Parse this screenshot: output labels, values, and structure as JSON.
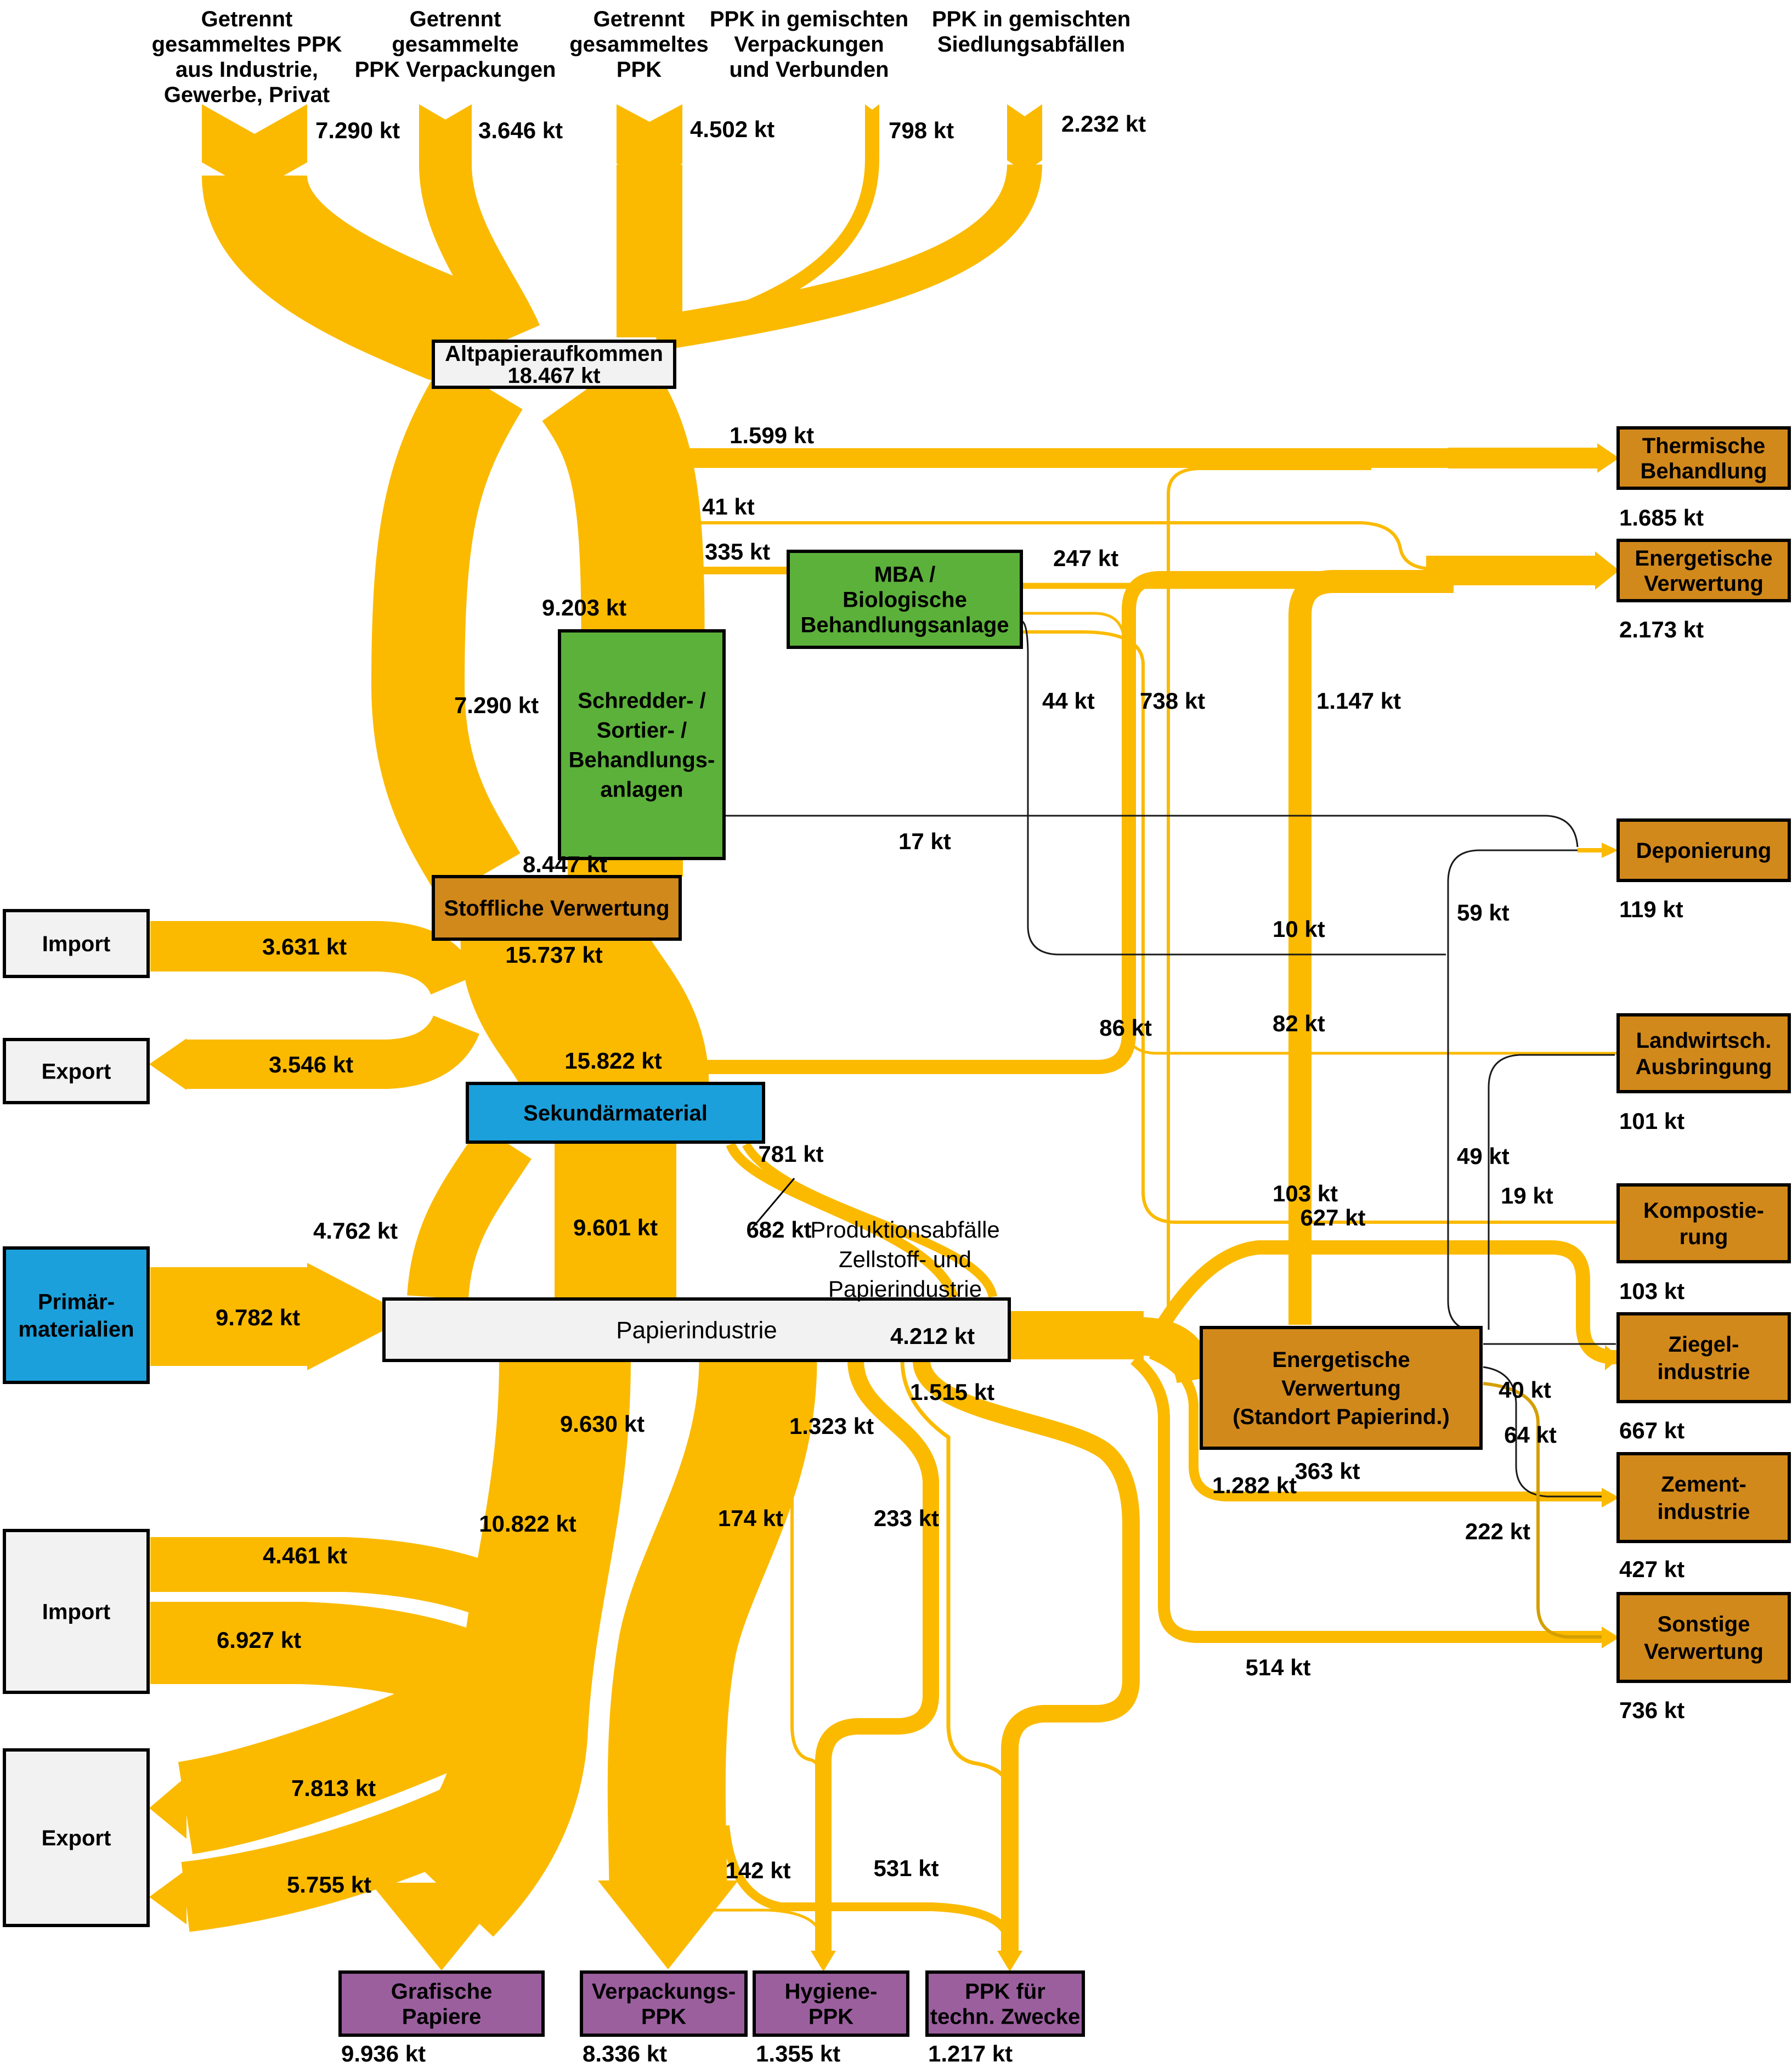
{
  "title": "PPK Stoffstrom Sankey",
  "colors": {
    "flow_yellow": "#FBBA00",
    "hairline_black": "#1a1a1a",
    "hairline_ochre": "#D59F00",
    "node_green": "#5CB13A",
    "node_orange": "#D2891B",
    "node_blue": "#1BA0DC",
    "node_purple": "#9B5F9E",
    "node_gray": "#F2F2F2",
    "border_black": "#000000"
  },
  "sources": [
    {
      "id": "src1",
      "lines": [
        "Getrennt",
        "gesammeltes PPK",
        "aus Industrie,",
        "Gewerbe, Privat"
      ],
      "value": "7.290 kt"
    },
    {
      "id": "src2",
      "lines": [
        "Getrennt",
        "gesammelte",
        "PPK Verpackungen"
      ],
      "value": "3.646 kt"
    },
    {
      "id": "src3",
      "lines": [
        "Getrennt",
        "gesammeltes",
        "PPK"
      ],
      "value": "4.502 kt"
    },
    {
      "id": "src4",
      "lines": [
        "PPK in gemischten",
        "Verpackungen",
        "und Verbunden"
      ],
      "value": "798 kt"
    },
    {
      "id": "src5",
      "lines": [
        "PPK in gemischten",
        "Siedlungsabfällen"
      ],
      "value": "2.232 kt"
    }
  ],
  "nodes": [
    {
      "id": "altpapier",
      "lines": [
        "Altpapieraufkommen",
        "18.467 kt"
      ],
      "color": "gray"
    },
    {
      "id": "mba",
      "lines": [
        "MBA /",
        "Biologische",
        "Behandlungsanlage"
      ],
      "color": "green"
    },
    {
      "id": "schredder",
      "lines": [
        "Schredder- /",
        "Sortier- /",
        "Behandlungs-",
        "anlagen"
      ],
      "color": "green"
    },
    {
      "id": "stoffliche",
      "lines": [
        "Stoffliche Verwertung"
      ],
      "color": "orange",
      "value": "15.737 kt"
    },
    {
      "id": "sekundaer",
      "lines": [
        "Sekundärmaterial"
      ],
      "color": "blue",
      "value": "15.822 kt"
    },
    {
      "id": "papier",
      "lines": [
        "Papierindustrie"
      ],
      "color": "gray"
    },
    {
      "id": "standort",
      "lines": [
        "Energetische",
        "Verwertung",
        "(Standort Papierind.)"
      ],
      "color": "orange",
      "value": "1.282 kt"
    },
    {
      "id": "import1",
      "lines": [
        "Import"
      ],
      "color": "gray"
    },
    {
      "id": "export1",
      "lines": [
        "Export"
      ],
      "color": "gray"
    },
    {
      "id": "primaer",
      "lines": [
        "Primär-",
        "materialien"
      ],
      "color": "blue"
    },
    {
      "id": "import2",
      "lines": [
        "Import"
      ],
      "color": "gray"
    },
    {
      "id": "export2",
      "lines": [
        "Export"
      ],
      "color": "gray"
    },
    {
      "id": "thermische",
      "lines": [
        "Thermische",
        "Behandlung"
      ],
      "color": "orange",
      "value": "1.685 kt"
    },
    {
      "id": "energetische",
      "lines": [
        "Energetische",
        "Verwertung"
      ],
      "color": "orange",
      "value": "2.173 kt"
    },
    {
      "id": "deponierung",
      "lines": [
        "Deponierung"
      ],
      "color": "orange",
      "value": "119 kt"
    },
    {
      "id": "landwirtsch",
      "lines": [
        "Landwirtsch.",
        "Ausbringung"
      ],
      "color": "orange",
      "value": "101 kt"
    },
    {
      "id": "kompostierung",
      "lines": [
        "Kompostie-",
        "rung"
      ],
      "color": "orange",
      "value": "103 kt"
    },
    {
      "id": "ziegel",
      "lines": [
        "Ziegel-",
        "industrie"
      ],
      "color": "orange",
      "value": "667 kt"
    },
    {
      "id": "zement",
      "lines": [
        "Zement-",
        "industrie"
      ],
      "color": "orange",
      "value": "427 kt"
    },
    {
      "id": "sonstige",
      "lines": [
        "Sonstige",
        "Verwertung"
      ],
      "color": "orange",
      "value": "736 kt"
    },
    {
      "id": "grafische",
      "lines": [
        "Grafische",
        "Papiere"
      ],
      "color": "purple",
      "value": "9.936 kt"
    },
    {
      "id": "verpackungs",
      "lines": [
        "Verpackungs-",
        "PPK"
      ],
      "color": "purple",
      "value": "8.336 kt"
    },
    {
      "id": "hygiene",
      "lines": [
        "Hygiene-",
        "PPK"
      ],
      "color": "purple",
      "value": "1.355 kt"
    },
    {
      "id": "techn",
      "lines": [
        "PPK für",
        "techn. Zwecke"
      ],
      "color": "purple",
      "value": "1.217 kt"
    }
  ],
  "flow_labels": [
    {
      "id": "f1599",
      "label": "1.599 kt"
    },
    {
      "id": "f41",
      "label": "41 kt"
    },
    {
      "id": "f335",
      "label": "335 kt"
    },
    {
      "id": "f9203",
      "label": "9.203 kt"
    },
    {
      "id": "f8447",
      "label": "8.447 kt"
    },
    {
      "id": "f247",
      "label": "247 kt"
    },
    {
      "id": "f44",
      "label": "44 kt"
    },
    {
      "id": "f738",
      "label": "738 kt"
    },
    {
      "id": "f1147",
      "label": "1.147 kt"
    },
    {
      "id": "f17",
      "label": "17 kt"
    },
    {
      "id": "f7290mid",
      "label": "7.290 kt"
    },
    {
      "id": "f15737",
      "label": "15.737 kt"
    },
    {
      "id": "f3631",
      "label": "3.631 kt"
    },
    {
      "id": "f3546",
      "label": "3.546 kt"
    },
    {
      "id": "f15822",
      "label": "15.822 kt"
    },
    {
      "id": "f59",
      "label": "59 kt"
    },
    {
      "id": "f10",
      "label": "10 kt"
    },
    {
      "id": "f49",
      "label": "49 kt"
    },
    {
      "id": "f86",
      "label": "86 kt"
    },
    {
      "id": "f82",
      "label": "82 kt"
    },
    {
      "id": "f103",
      "label": "103 kt"
    },
    {
      "id": "f19",
      "label": "19 kt"
    },
    {
      "id": "f627",
      "label": "627 kt"
    },
    {
      "id": "f4762",
      "label": "4.762 kt"
    },
    {
      "id": "f9601",
      "label": "9.601 kt"
    },
    {
      "id": "f781",
      "label": "781 kt"
    },
    {
      "id": "f682",
      "label": "682 kt"
    },
    {
      "id": "f4212",
      "label": "4.212 kt"
    },
    {
      "id": "f9782",
      "label": "9.782 kt"
    },
    {
      "id": "f40",
      "label": "40 kt"
    },
    {
      "id": "f64",
      "label": "64 kt"
    },
    {
      "id": "f222",
      "label": "222 kt"
    },
    {
      "id": "f363",
      "label": "363 kt"
    },
    {
      "id": "f514",
      "label": "514 kt"
    },
    {
      "id": "f10822",
      "label": "10.822 kt"
    },
    {
      "id": "f9630",
      "label": "9.630 kt"
    },
    {
      "id": "f1515",
      "label": "1.515 kt"
    },
    {
      "id": "f1323",
      "label": "1.323 kt"
    },
    {
      "id": "f174",
      "label": "174 kt"
    },
    {
      "id": "f233",
      "label": "233 kt"
    },
    {
      "id": "f4461",
      "label": "4.461 kt"
    },
    {
      "id": "f6927",
      "label": "6.927 kt"
    },
    {
      "id": "f7813",
      "label": "7.813 kt"
    },
    {
      "id": "f5755",
      "label": "5.755 kt"
    },
    {
      "id": "f142",
      "label": "142 kt"
    },
    {
      "id": "f531",
      "label": "531 kt"
    }
  ],
  "annotation": {
    "id": "produktionsabfaelle",
    "lines": [
      "Produktionsabfälle",
      "Zellstoff- und",
      "Papierindustrie"
    ]
  }
}
